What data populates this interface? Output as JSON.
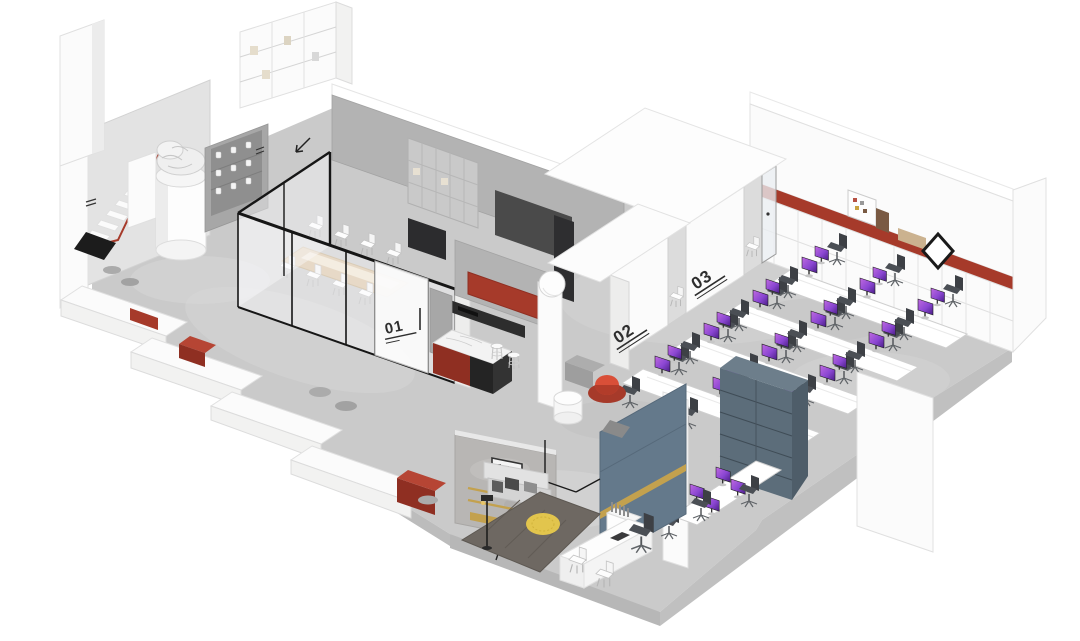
{
  "image_type": "isometric office interior floor plan rendering",
  "labels": {
    "meeting_room": "01",
    "booth_front": "02",
    "booth_back": "03"
  },
  "colors": {
    "accent_red": "#a63a2a",
    "deep_red": "#8f2f22",
    "floor_gray": "#cacaca",
    "slate_shelf": "#5c6d7a",
    "partition_blue": "#64798b",
    "brass_gold": "#c3a14e",
    "monitor_screen": "#8a46d2",
    "wood_table": "#d9c2a0",
    "chair_dark": "#46494e",
    "rug_dark": "#6e6862",
    "rug_accent_yellow": "#e2c54d"
  },
  "open_office": {
    "rows": 4,
    "desks_per_row": 3
  },
  "cluster": {
    "monitors": 4,
    "chairs": 3
  },
  "meeting_room": {
    "seats": 8
  },
  "pantry": {
    "bar_stools": 2
  },
  "booths": {
    "count": 2
  }
}
